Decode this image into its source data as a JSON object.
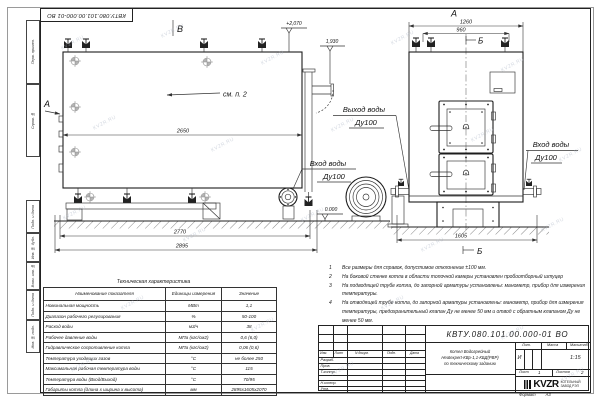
{
  "watermark": {
    "text": "KVZR.RU"
  },
  "frame": {
    "stamp_code_top": "КВТУ.080.101.00.000-01  ВО",
    "margin_labels": [
      "Перв. примен.",
      "Справ. №",
      "Подп. и дата",
      "Инв. № дубл.",
      "Взам. инв. №",
      "Подп. и дата",
      "Инв. № подл."
    ],
    "format_label": "Формат",
    "format_value": "А3"
  },
  "drawing": {
    "view_b": "В",
    "view_a_side": "А",
    "view_a_front": "А",
    "section_b_top": "Б",
    "section_b_bottom": "Б",
    "callout_see_item": "см. п. 2",
    "dim_2650": "2650",
    "dim_2770": "2770",
    "dim_2895": "2895",
    "dim_1260": "1260",
    "dim_960": "960",
    "dim_1605": "1605",
    "elev_plus_2070": "+2,070",
    "elev_1930": "1,930",
    "elev_zero": "0.000",
    "outlet_label": "Выход воды",
    "outlet_dn": "Ду100",
    "inlet_label_side": "Вход воды",
    "inlet_dn_side": "Ду100",
    "inlet_label_front": "Вход воды",
    "inlet_dn_front": "Ду100"
  },
  "notes": [
    {
      "num": "1",
      "text": "Все размеры для справок, допустимое отклонение ±100 мм."
    },
    {
      "num": "2",
      "text": "На боковой стенке котла в области топочной камеры установлен пробоотборный штуцер"
    },
    {
      "num": "3",
      "text": "На  подводящей трубе котла, до запорной арматуры установлены: манометр, прибор для измерения температуры."
    },
    {
      "num": "4",
      "text": "На отводящей трубе котла, до запорной арматуры установлены: манометр, прибор для измерения температуры, предохранительный клапан Ду не менее 50 мм и отвод с обратным клапаном Ду не менее 50 мм."
    }
  ],
  "spec_table": {
    "title": "Техническая характеристика",
    "headers": [
      "Наименование показателя",
      "Единицы измерения",
      "Значение"
    ],
    "rows": [
      {
        "name": "Номинальная мощность",
        "units": "МВт",
        "value": "1,1"
      },
      {
        "name": "Диапазон рабочего регулирования",
        "units": "%",
        "value": "50-100"
      },
      {
        "name": "Расход воды",
        "units": "м3/ч",
        "value": "38"
      },
      {
        "name": "Рабочее давление воды",
        "units": "МПа (кгс/см2)",
        "value": "0,6 (6,0)"
      },
      {
        "name": "Гидравлическое сопротивление котла",
        "units": "МПа (кгс/см2)",
        "value": "0,06 (0,6)"
      },
      {
        "name": "Температура уходящих газов",
        "units": "°С",
        "value": "не более 250"
      },
      {
        "name": "Максимальная рабочая температура воды",
        "units": "°С",
        "value": "115"
      },
      {
        "name": "Температура воды (Вход/Выход)",
        "units": "°С",
        "value": "70/95"
      },
      {
        "name": "Габариты котла (длина х ширина х высота)",
        "units": "мм",
        "value": "2895х1605х2070"
      }
    ]
  },
  "titleblock": {
    "code": "КВТУ.080.101.00.000-01  ВО",
    "doc_title": "Котел Водогрейный\nHeatexpert-КВр-1,1-КБД(РВР)\nпо техническому заданию",
    "col_izm": "Изм.",
    "col_list": "Лист",
    "col_ndoc": "N докум.",
    "col_podp": "Подп.",
    "col_data": "Дата",
    "row_razrab": "Разраб.",
    "row_prov": "Пров.",
    "row_tkontr": "Т.контр.",
    "row_nkontr": "Н.контр.",
    "row_utv": "Утв.",
    "lit_header": "Лит.",
    "mass_header": "Масса",
    "scale_header": "Масштаб",
    "lit_value": "И",
    "scale_value": "1:15",
    "sheet_label": "Лист",
    "sheet_value": "1",
    "sheets_label": "Листов",
    "sheets_value": "2",
    "logo_text": "KVZR",
    "company_line1": "КОТЕЛЬНЫЙ",
    "company_line2": "ЗАВОД РЭП"
  }
}
